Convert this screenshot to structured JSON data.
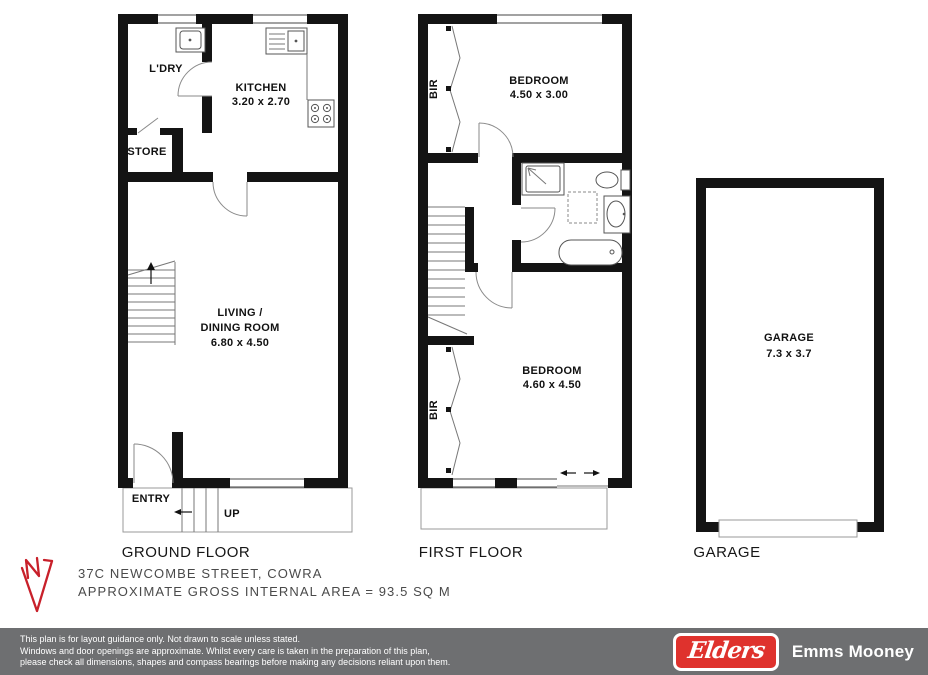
{
  "colors": {
    "wall": "#141414",
    "compass_red": "#c8202a",
    "footer_bar_gray": "#6e6f71",
    "elders_red": "#df322d"
  },
  "ground_floor": {
    "label": "GROUND FLOOR",
    "ldry": "L'DRY",
    "kitchen_name": "KITCHEN",
    "kitchen_dims": "3.20 x 2.70",
    "store": "STORE",
    "living_line1": "LIVING /",
    "living_line2": "DINING ROOM",
    "living_dims": "6.80 x 4.50",
    "entry": "ENTRY",
    "up": "UP"
  },
  "first_floor": {
    "label": "FIRST FLOOR",
    "bir_top": "BIR",
    "bedroom1_name": "BEDROOM",
    "bedroom1_dims": "4.50 x 3.00",
    "bedroom2_name": "BEDROOM",
    "bedroom2_dims": "4.60 x 4.50",
    "bir_bottom": "BIR"
  },
  "garage": {
    "label": "GARAGE",
    "room_name": "GARAGE",
    "room_dims": "7.3 x 3.7"
  },
  "summary": {
    "address": "37C NEWCOMBE STREET, COWRA",
    "area": "APPROXIMATE GROSS INTERNAL AREA = 93.5 SQ M"
  },
  "footer": {
    "disclaimer_line1": "This plan is for layout guidance only. Not drawn to scale unless stated.",
    "disclaimer_line2": "Windows and door openings are approximate. Whilst every care is taken in the preparation of this plan,",
    "disclaimer_line3": "please check all dimensions, shapes and compass bearings before making any decisions reliant upon them.",
    "brand": "Elders",
    "agency": "Emms Mooney"
  }
}
